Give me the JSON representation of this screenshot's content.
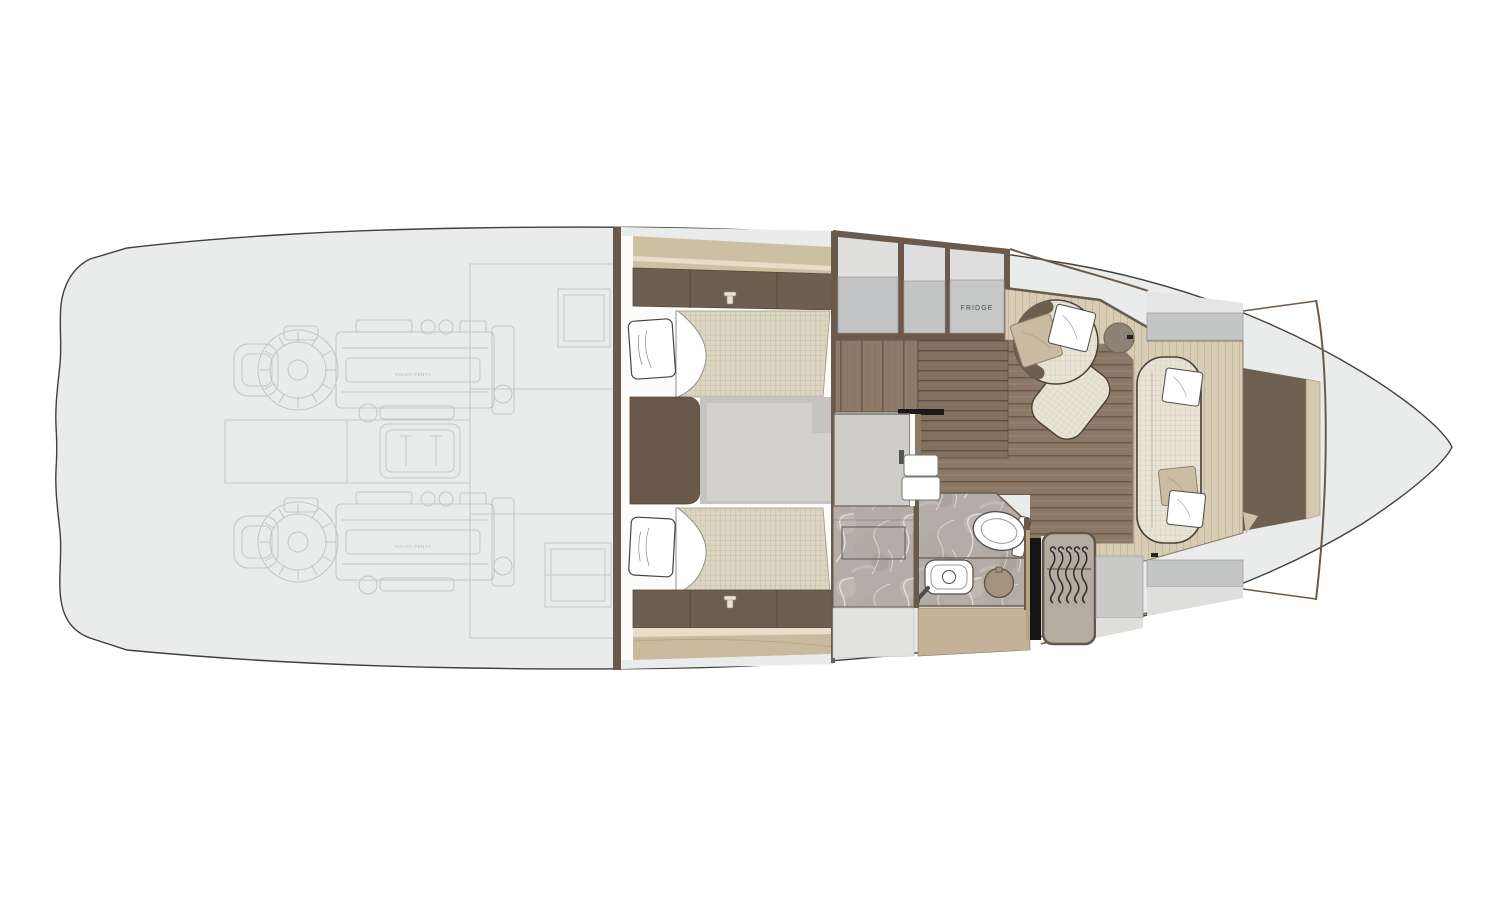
{
  "labels": {
    "fridge": "FRIDGE",
    "engine_brand": "VOLVO PENTA"
  },
  "palette": {
    "hull_fill": "#eaebeb",
    "hull_line": "#3f3f3f",
    "engine_line_art": "#c2c5c8",
    "wall_brown": "#6b5a4a",
    "cabinet_dark_brown": "#6e5e4f",
    "wood_floor": "#8b7867",
    "wood_cabinet": "#8d7a68",
    "platform_light_wood": "#d9ccb5",
    "fabric_weave": "#dcd6c3",
    "tan_band": "#cdbfa2",
    "marble": "#b4ada7",
    "panel_grey": "#c4c5c5",
    "galley_unit_grey": "#c6c7c7",
    "beige_cabinet_front": "#c3b298",
    "accent_black_trim": "#141414",
    "fixture_white": "#ffffff"
  }
}
